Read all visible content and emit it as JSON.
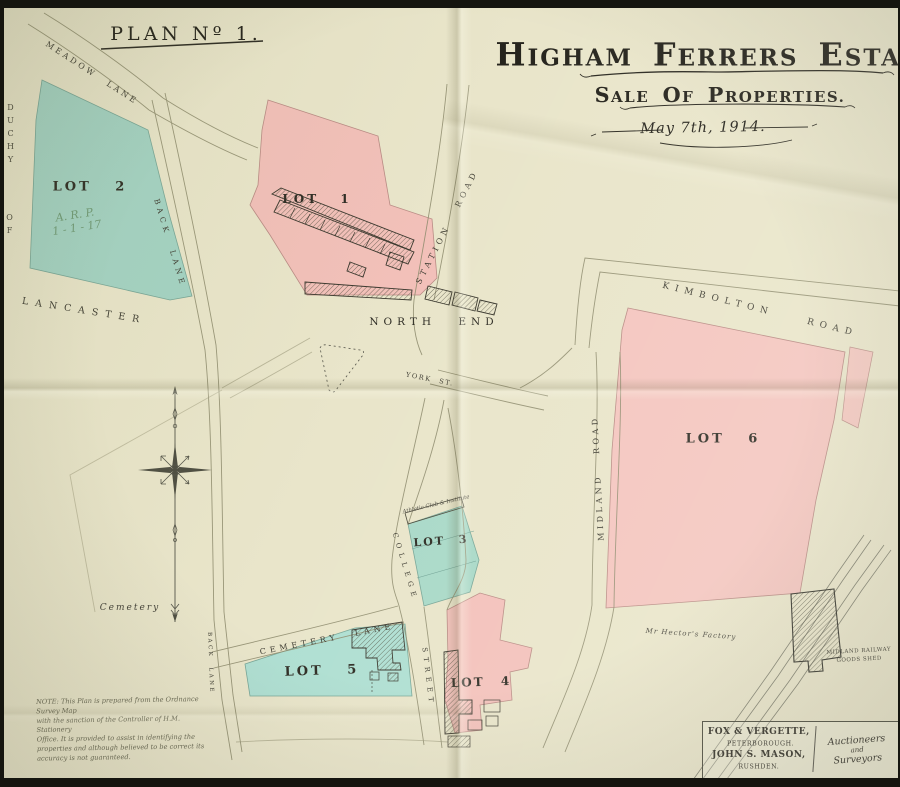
{
  "header": {
    "plan_no": "Plan Nº 1.",
    "title_words": [
      "Higham",
      "Ferrers",
      "Estate."
    ],
    "subtitle_words": [
      "Sale",
      "of",
      "Properties."
    ],
    "date": "May 7th, 1914."
  },
  "lots": {
    "lot1": "LOT 1",
    "lot2": "LOT 2",
    "lot3": "LOT 3",
    "lot4": "LOT 4",
    "lot5": "LOT 5",
    "lot6": "LOT 6",
    "lot2_annotation_line1": "A. R. P.",
    "lot2_annotation_line2": "1 - 1 - 17"
  },
  "roads": {
    "meadow_lane": "MEADOW LANE",
    "back_lane_north": "BACK LANE",
    "back_lane_south": "BACK LANE",
    "station_road": "STATION ROAD",
    "york_street": "YORK ST.",
    "kimbolton_road": "KIMBOLTON ROAD",
    "midland_road": "MIDLAND ROAD",
    "college": "COLLEGE",
    "street": "STREET",
    "cemetery_lane": "CEMETERY LANE"
  },
  "places": {
    "north_end": "NORTH END",
    "duchy": "DUCHY",
    "of": "OF",
    "lancaster": "LANCASTER",
    "cemetery": "Cemetery",
    "athletic_club": "Athletic Club & Institute",
    "hectors_factory": "Mr Hector's Factory",
    "goods_shed_line1": "MIDLAND RAILWAY",
    "goods_shed_line2": "GOODS SHED"
  },
  "note": {
    "lines": [
      "NOTE: This Plan is prepared from the Ordnance Survey Map",
      "with the sanction of the Controller of H.M. Stationery",
      "Office.  It is provided to assist in identifying the",
      "properties and although believed to be correct its",
      "accuracy is not guaranteed."
    ]
  },
  "imprint": {
    "firm1_name": "FOX & VERGETTE,",
    "firm1_town": "PETERBOROUGH.",
    "firm2_name": "JOHN S. MASON,",
    "firm2_town": "RUSHDEN.",
    "role_line1": "Auctioneers",
    "role_line2": "and",
    "role_line3": "Surveyors"
  },
  "colors": {
    "paper": "#e9e5ca",
    "lot_pink": "#f4c0bb",
    "lot_blue": "#a7d8c9",
    "ink": "#2c2a22",
    "road_line": "#8f8c6e"
  }
}
